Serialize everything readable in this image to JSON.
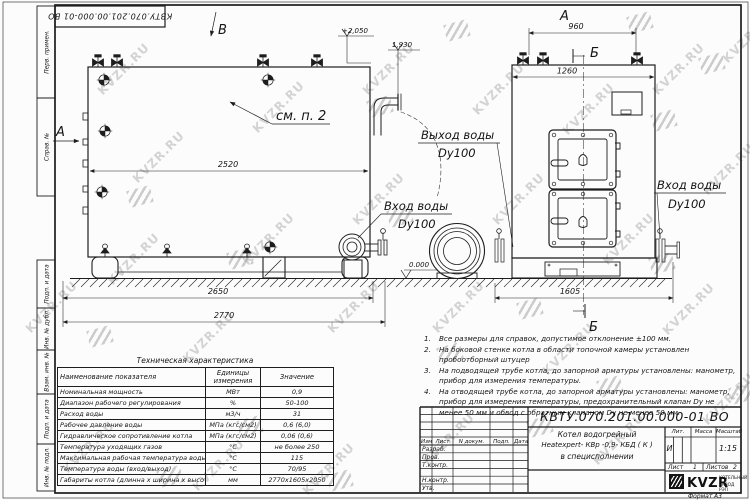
{
  "sheet": {
    "doc_number": "КВТУ.070.201.00.000-01 ВО",
    "format_label": "Формат",
    "format_value": "А3"
  },
  "frame_labels": [
    "Перв. примен.",
    "Справ. №",
    "Подп. и дата",
    "Инв. № дубл.",
    "Взам. инв. №",
    "Подп. и дата",
    "Инв. № подл."
  ],
  "watermarks": {
    "text": "KVZR.RU",
    "text_positions": [
      [
        18,
        300
      ],
      [
        90,
        62
      ],
      [
        55,
        440
      ],
      [
        125,
        150
      ],
      [
        100,
        252
      ],
      [
        175,
        330
      ],
      [
        185,
        458
      ],
      [
        245,
        100
      ],
      [
        235,
        232
      ],
      [
        320,
        300
      ],
      [
        295,
        462
      ],
      [
        355,
        62
      ],
      [
        345,
        192
      ],
      [
        425,
        300
      ],
      [
        415,
        432
      ],
      [
        465,
        82
      ],
      [
        485,
        192
      ],
      [
        535,
        342
      ],
      [
        555,
        102
      ],
      [
        595,
        232
      ],
      [
        585,
        432
      ],
      [
        645,
        62
      ],
      [
        655,
        302
      ],
      [
        695,
        162
      ],
      [
        695,
        392
      ],
      [
        715,
        30
      ]
    ],
    "logo_positions": [
      [
        445,
        22
      ],
      [
        628,
        14
      ],
      [
        700,
        55
      ],
      [
        368,
        98
      ],
      [
        652,
        112
      ],
      [
        128,
        188
      ],
      [
        388,
        208
      ],
      [
        228,
        250
      ],
      [
        650,
        255
      ],
      [
        88,
        328
      ],
      [
        438,
        345
      ],
      [
        518,
        300
      ],
      [
        730,
        385
      ],
      [
        238,
        418
      ],
      [
        528,
        418
      ],
      [
        158,
        468
      ],
      [
        328,
        472
      ],
      [
        598,
        378
      ]
    ]
  },
  "views": {
    "side": {
      "letter_b": "В",
      "letter_a": "А",
      "see_note": "см. п. 2",
      "dim_width": "2520",
      "dim_base": "2650",
      "dim_total": "2770",
      "elev_top": "+2,050",
      "elev_step": "1,930",
      "elev_zero": "0.000",
      "outlet_label": "Выход воды",
      "outlet_dn": "Dy100",
      "inlet_label": "Вход воды",
      "inlet_dn": "Dy100"
    },
    "front": {
      "letter_a": "А",
      "letter_b_top": "Б",
      "letter_b_bottom": "Б",
      "dim_valves": "960",
      "dim_width": "1260",
      "dim_base": "1605",
      "inlet_label": "Вход воды",
      "inlet_dn": "Dy100"
    }
  },
  "notes": [
    {
      "num": "1.",
      "text": "Все размеры для справок, допустимое отклонение ±100 мм."
    },
    {
      "num": "2.",
      "text": "На боковой стенке котла в области топочной камеры установлен пробоотборный штуцер"
    },
    {
      "num": "3.",
      "text": "На подводящей трубе котла, до запорной арматуры установлены: манометр, прибор для измерения температуры."
    },
    {
      "num": "4.",
      "text": "На отводящей трубе котла, до запорной арматуры установлены: манометр, прибор для измерения температуры, предохранительный клапан Dу не менее 50 мм и обвод с обратным клапаном Dу не менее 50 мм."
    }
  ],
  "spec_table": {
    "title": "Техническая характеристика",
    "headers": [
      "Наименование показателя",
      "Единицы измерения",
      "Значение"
    ],
    "rows": [
      [
        "Номинальная мощность",
        "МВт",
        "0,9"
      ],
      [
        "Диапазон рабочего регулирования",
        "%",
        "50-100"
      ],
      [
        "Расход воды",
        "м3/ч",
        "31"
      ],
      [
        "Рабочее давление воды",
        "МПа (кгс/см2)",
        "0,6 (6,0)"
      ],
      [
        "Гидравлическое сопротивление котла",
        "МПа (кгс/см2)",
        "0,06 (0,6)"
      ],
      [
        "Температура уходящих газов",
        "°С",
        "не более 250"
      ],
      [
        "Максимальная рабочая температура воды",
        "°С",
        "115"
      ],
      [
        "Температура воды (вход/выход)",
        "°С",
        "70/95"
      ],
      [
        "Габариты котла (длинна х ширина х высота)",
        "мм",
        "2770х1605х2050"
      ]
    ]
  },
  "title_block": {
    "header_cols": [
      "Изм",
      "Лист",
      "N докум.",
      "Подп.",
      "Дата"
    ],
    "row_labels": [
      "Разраб.",
      "Пров.",
      "Т.контр.",
      "Н.контр.",
      "Утв."
    ],
    "product_name_1": "Котел водогрейный",
    "product_name_2": "Heatexpert- КВр -0,9- КБД ( К )",
    "product_name_3": "в специсполнении",
    "lit_label": "Лит.",
    "lit_value": "И",
    "mass_label": "Масса",
    "scale_label": "Масштаб",
    "scale_value": "1:15",
    "sheet_label": "Лист",
    "sheet_value": "1",
    "sheets_label": "Листов",
    "sheets_value": "2",
    "company_logo": "KVZR",
    "company_line1": "КОТЕЛЬНЫЙ",
    "company_line2": "ЗАВОД РЭП"
  }
}
